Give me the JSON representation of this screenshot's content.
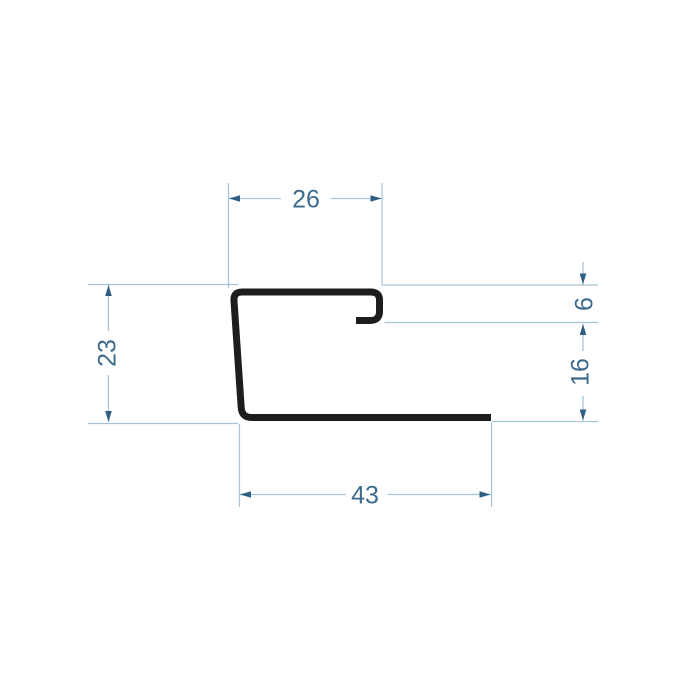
{
  "drawing": {
    "title": "profile-cross-section-drawing",
    "dimensions": {
      "top_width": "26",
      "left_height": "23",
      "lip_depth": "6",
      "right_height": "16",
      "bottom_width": "43"
    },
    "colors": {
      "profile_stroke": "#1d1d1b",
      "dimension_line": "#a6c4d7",
      "arrowhead": "#2e5f83",
      "dimension_text": "#3d6b8d",
      "background": "#ffffff"
    }
  }
}
